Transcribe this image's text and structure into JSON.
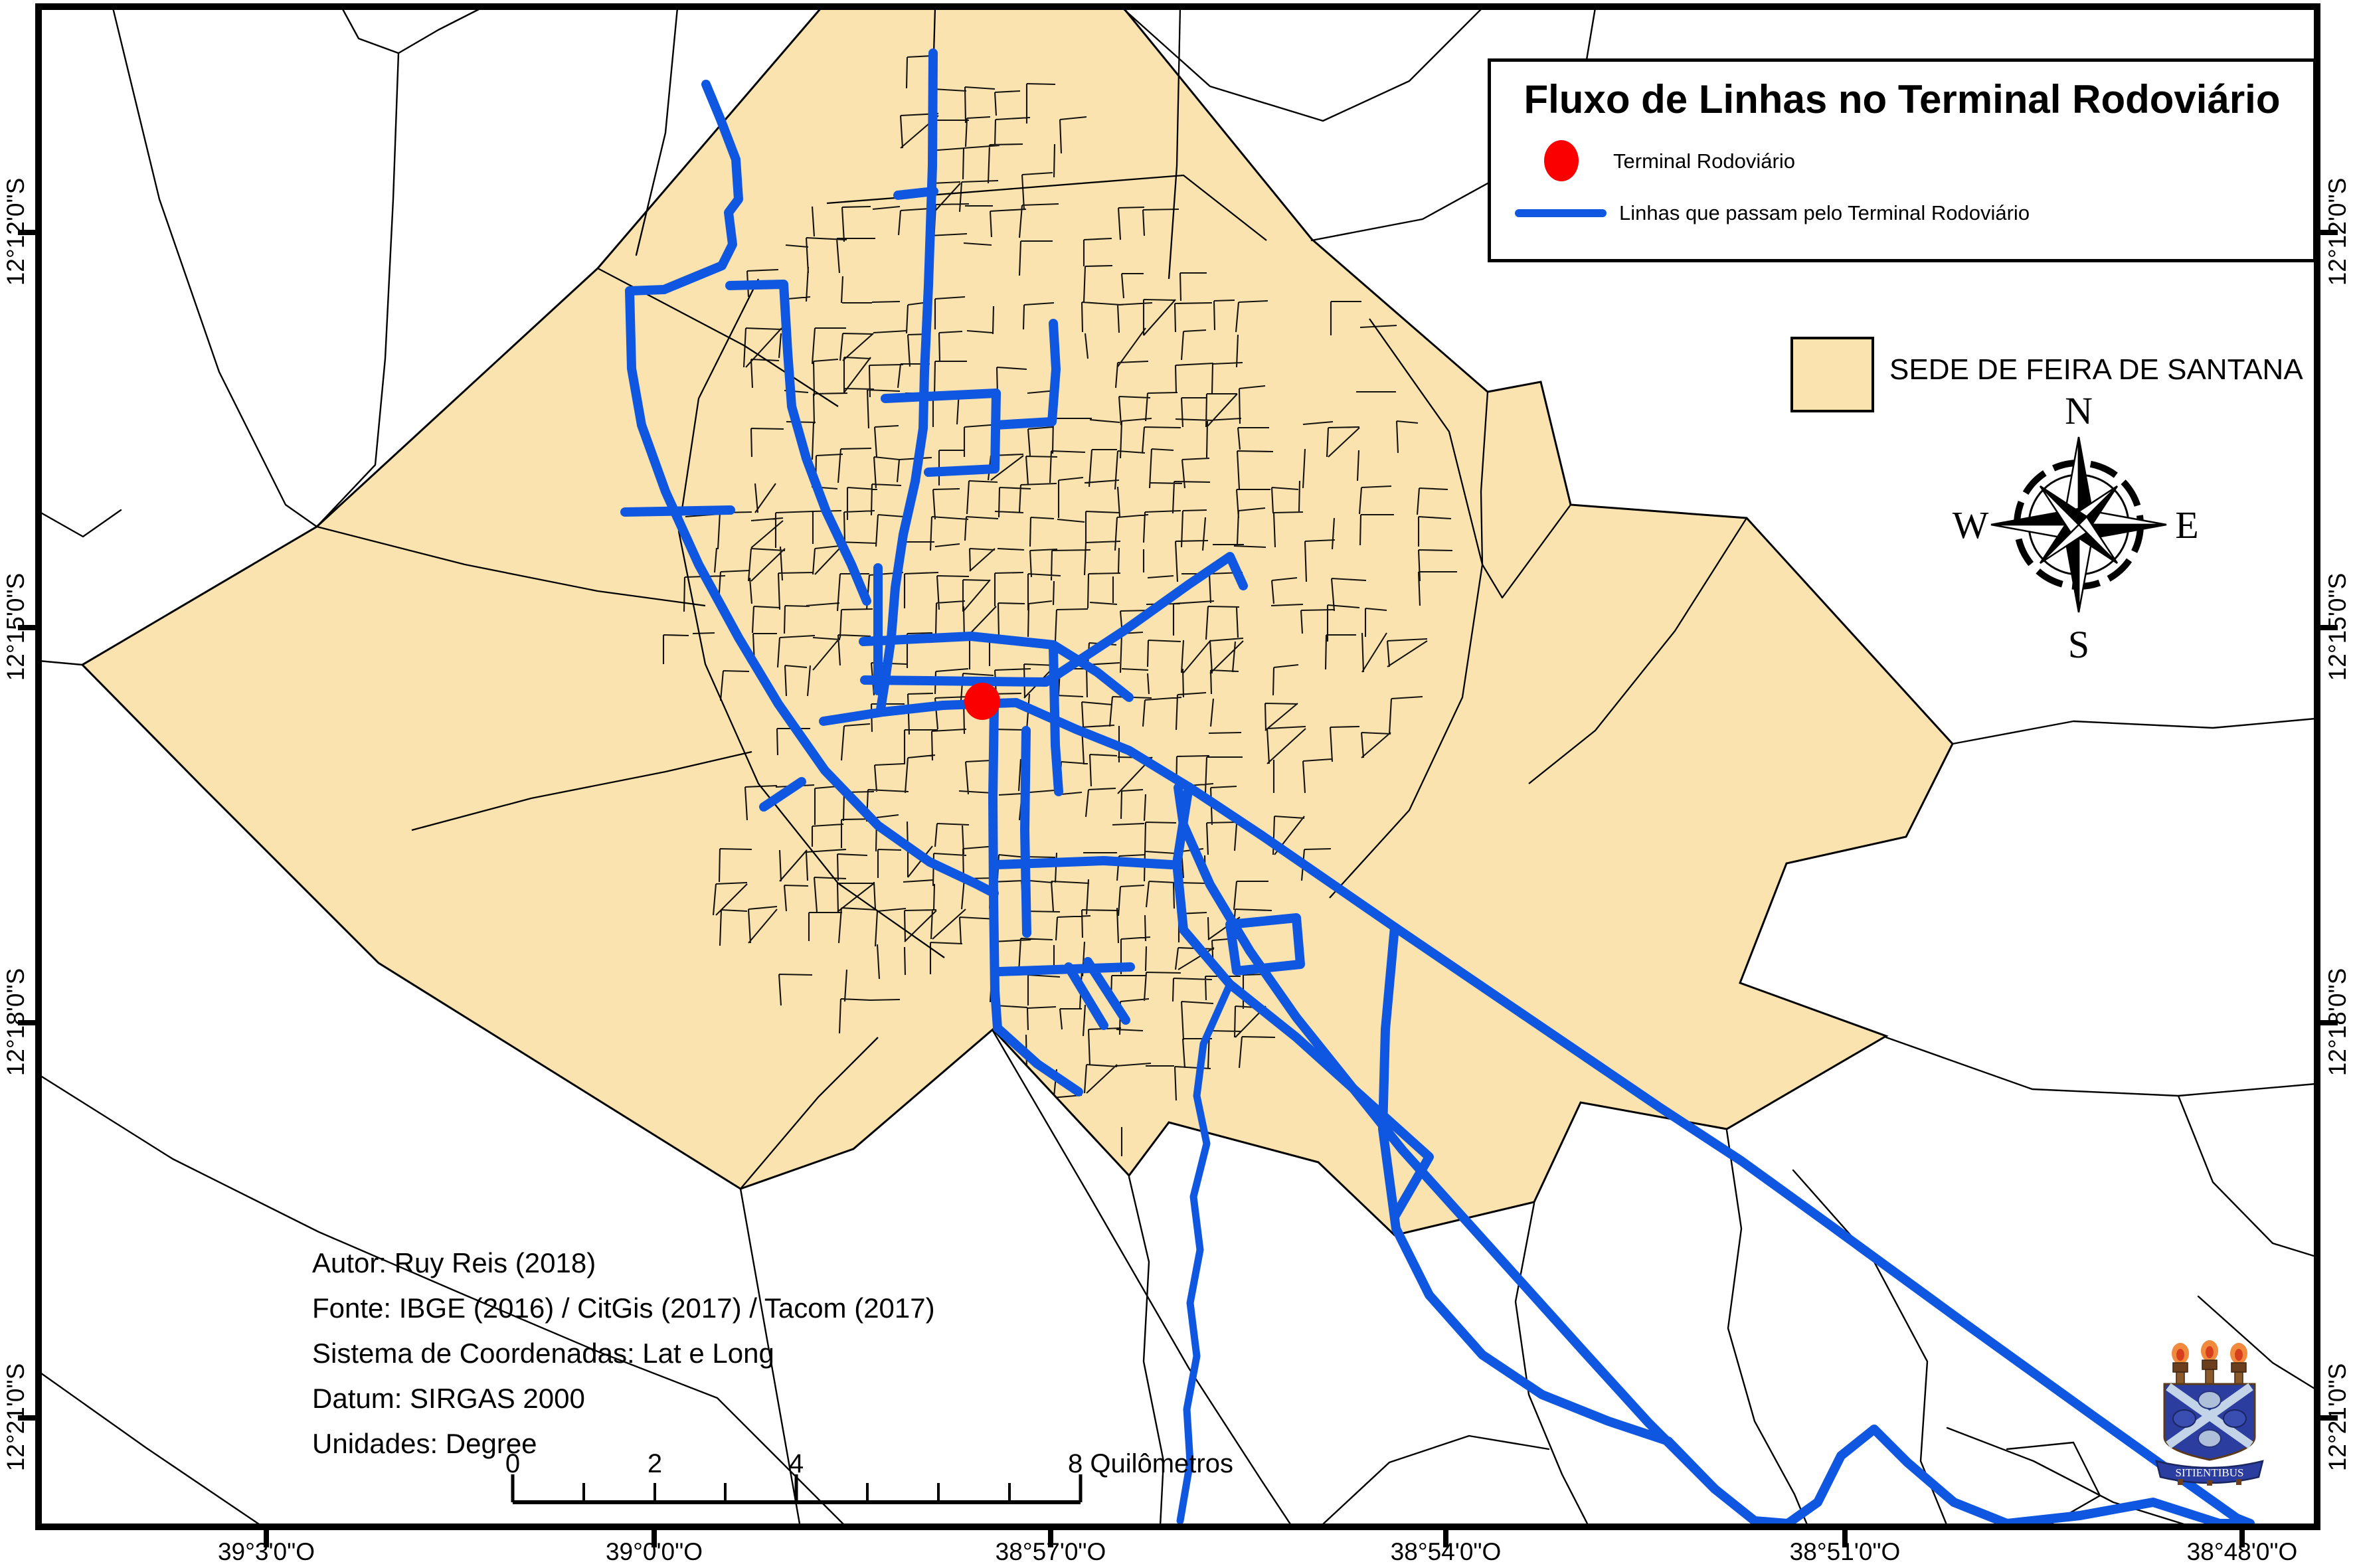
{
  "title_box": {
    "title": "Fluxo de Linhas no Terminal Rodoviário",
    "legend": [
      {
        "icon": "terminal-dot",
        "label": "Terminal Rodoviário",
        "color": "#FA0000"
      },
      {
        "icon": "route-line",
        "label": "Linhas que passam pelo Terminal Rodoviário",
        "color": "#0F57E0"
      }
    ]
  },
  "sede_legend": {
    "label": "SEDE DE FEIRA DE SANTANA",
    "color": "#FBE3AF"
  },
  "compass": {
    "n": "N",
    "e": "E",
    "s": "S",
    "w": "W"
  },
  "credits": {
    "lines": [
      "Autor: Ruy Reis (2018)",
      "Fonte: IBGE (2016) / CitGis (2017) / Tacom (2017)",
      "Sistema de Coordenadas: Lat e Long",
      "Datum: SIRGAS 2000",
      "Unidades: Degree"
    ]
  },
  "scalebar": {
    "labels": [
      "0",
      "2",
      "4"
    ],
    "end_label": "8 Quilômetros"
  },
  "axes": {
    "bottom": [
      "39°3'0\"O",
      "39°0'0\"O",
      "38°57'0\"O",
      "38°54'0\"O",
      "38°51'0\"O",
      "38°48'0\"O"
    ],
    "left": [
      "12°12'0\"S",
      "12°15'0\"S",
      "12°18'0\"S",
      "12°21'0\"S"
    ],
    "right": [
      "12°12'0\"S",
      "12°15'0\"S",
      "12°18'0\"S",
      "12°21'0\"S"
    ]
  },
  "logo": {
    "motto": "SITIENTIBUS"
  },
  "colors": {
    "sede_fill": "#FBE3AF",
    "route_blue": "#0F57E0",
    "terminal_red": "#FA0000",
    "boundary": "#000000"
  }
}
